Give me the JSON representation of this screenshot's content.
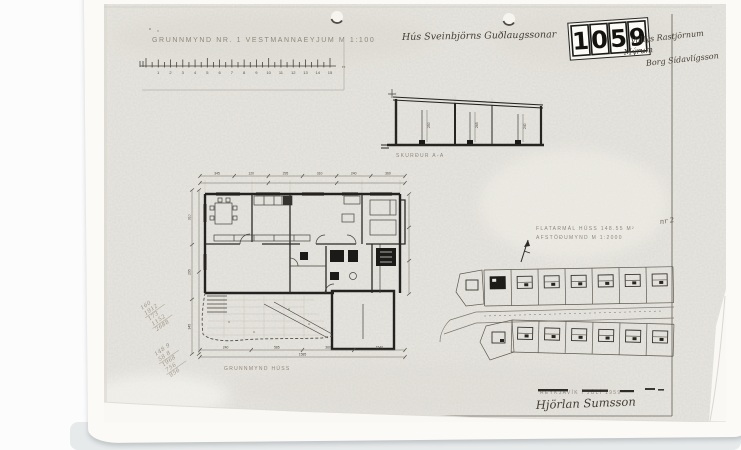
{
  "colors": {
    "photo_bg": "#e9e7e1",
    "ink": "#26251f",
    "faint_print": "#857f74",
    "pencil": "#9d968a",
    "paper": "#fbfaf6"
  },
  "title": {
    "printed": "GRUNNMYND NR. 1 VESTMANNAEYJUM M 1:100",
    "handwritten": "Hús Sveinbjörns Guðlaugssonar"
  },
  "stamp": {
    "digits": [
      "1",
      "0",
      "5",
      "9"
    ]
  },
  "corner_note": {
    "lines": [
      "Vallýs Rastjörnum",
      "Mýrum",
      "Borg Sídavlígsson"
    ]
  },
  "scale_ruler": {
    "numbers": [
      "1",
      "2",
      "3",
      "4",
      "5",
      "6",
      "7",
      "8",
      "9",
      "10",
      "11",
      "12",
      "13",
      "14",
      "15"
    ],
    "unit": "m"
  },
  "section": {
    "label": "SKURÐUR A-A",
    "dims": [
      "250",
      "265",
      "240"
    ]
  },
  "plan": {
    "label": "GRUNNMYND HÚSS",
    "dims_top": [
      "345",
      "120",
      "295",
      "310",
      "240",
      "360"
    ],
    "dims_left": [
      "310",
      "295",
      "345"
    ],
    "dims_bottom": [
      "240",
      "585",
      "360",
      "1540"
    ],
    "total": "1585"
  },
  "area_note": {
    "line1": "FLATARMÁL HÚSS 148.55 M²",
    "line2": "AFSTÖÐUMYND M 1:2000",
    "hand": "nr 2"
  },
  "site_plan": {
    "top_row_lots": 7,
    "bottom_row_lots": 6
  },
  "pencil_calc": {
    "stack1": [
      "160",
      "1912",
      "173",
      "1152",
      "2688"
    ],
    "stack2": [
      "148 9",
      "58 8",
      "1968",
      "756",
      "956"
    ]
  },
  "footer": {
    "printed": "REYKJAVÍK Í JÚLÍ 1959",
    "signature": "Hjörlan Sumsson"
  }
}
